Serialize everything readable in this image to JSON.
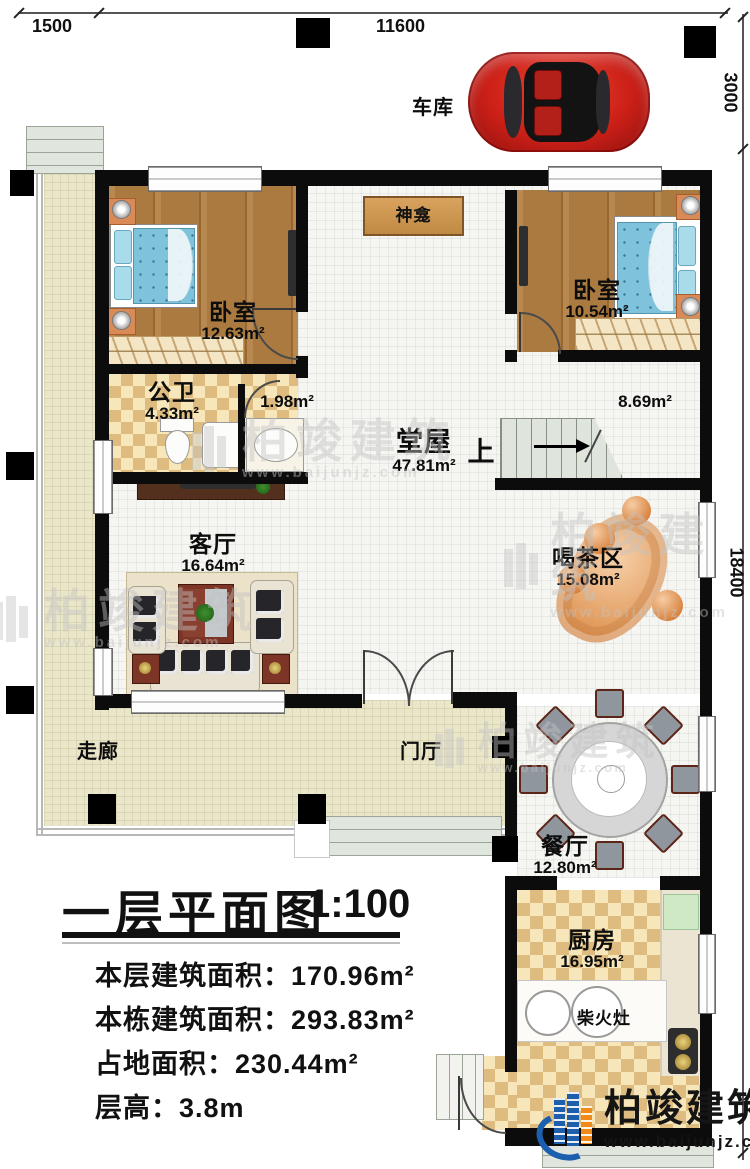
{
  "dimensions": {
    "top_left": "1500",
    "top": "11600",
    "right_upper": "3000",
    "right_lower": "18400"
  },
  "rooms": {
    "garage": {
      "name": "车库"
    },
    "shrine": {
      "name": "神龛"
    },
    "bedroom_left": {
      "name": "卧室",
      "area": "12.63m²"
    },
    "bedroom_right": {
      "name": "卧室",
      "area": "10.54m²"
    },
    "bathroom": {
      "name": "公卫",
      "area": "4.33m²"
    },
    "closet_area": {
      "area": "1.98m²"
    },
    "hall": {
      "name": "堂屋",
      "area": "47.81m²"
    },
    "landing_area": {
      "area": "8.69m²"
    },
    "stairs": {
      "up_label": "上"
    },
    "living": {
      "name": "客厅",
      "area": "16.64m²"
    },
    "tea": {
      "name": "喝茶区",
      "area": "15.08m²"
    },
    "corridor": {
      "name": "走廊"
    },
    "foyer": {
      "name": "门厅"
    },
    "dining": {
      "name": "餐厅",
      "area": "12.80m²"
    },
    "kitchen": {
      "name": "厨房",
      "area": "16.95m²"
    },
    "wood_stove": {
      "name": "柴火灶"
    }
  },
  "title_block": {
    "title": "一层平面图",
    "scale": "1:100",
    "lines": [
      "本层建筑面积：170.96m²",
      "本栋建筑面积：293.83m²",
      "占地面积：230.44m²",
      "层高：3.8m"
    ]
  },
  "branding": {
    "name": "柏竣建筑",
    "url": "www.baijunjz.com"
  },
  "watermark": {
    "text": "柏竣建筑",
    "url": "www.baijunjz.com"
  }
}
